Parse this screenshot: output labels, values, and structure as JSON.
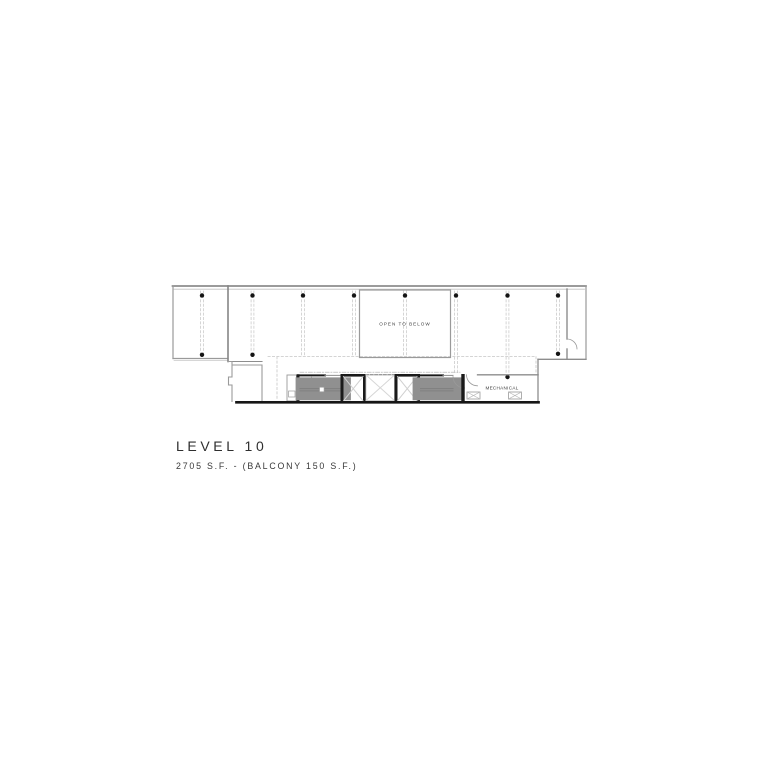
{
  "caption": {
    "title": "LEVEL 10",
    "area_note": "2705 S.F. - (BALCONY 150 S.F.)"
  },
  "plan": {
    "open_to_below_label": "OPEN TO BELOW",
    "mechanical_label": "MECHANICAL"
  },
  "colors": {
    "background": "#ffffff",
    "wall_gray": "#8d8d8d",
    "wall_light": "#c0c0c0",
    "wall_black": "#1a1a1a",
    "grid_dash": "#cbcbcb",
    "shaft_x": "#d0d0d0",
    "text_dark": "#2f2f2f"
  }
}
